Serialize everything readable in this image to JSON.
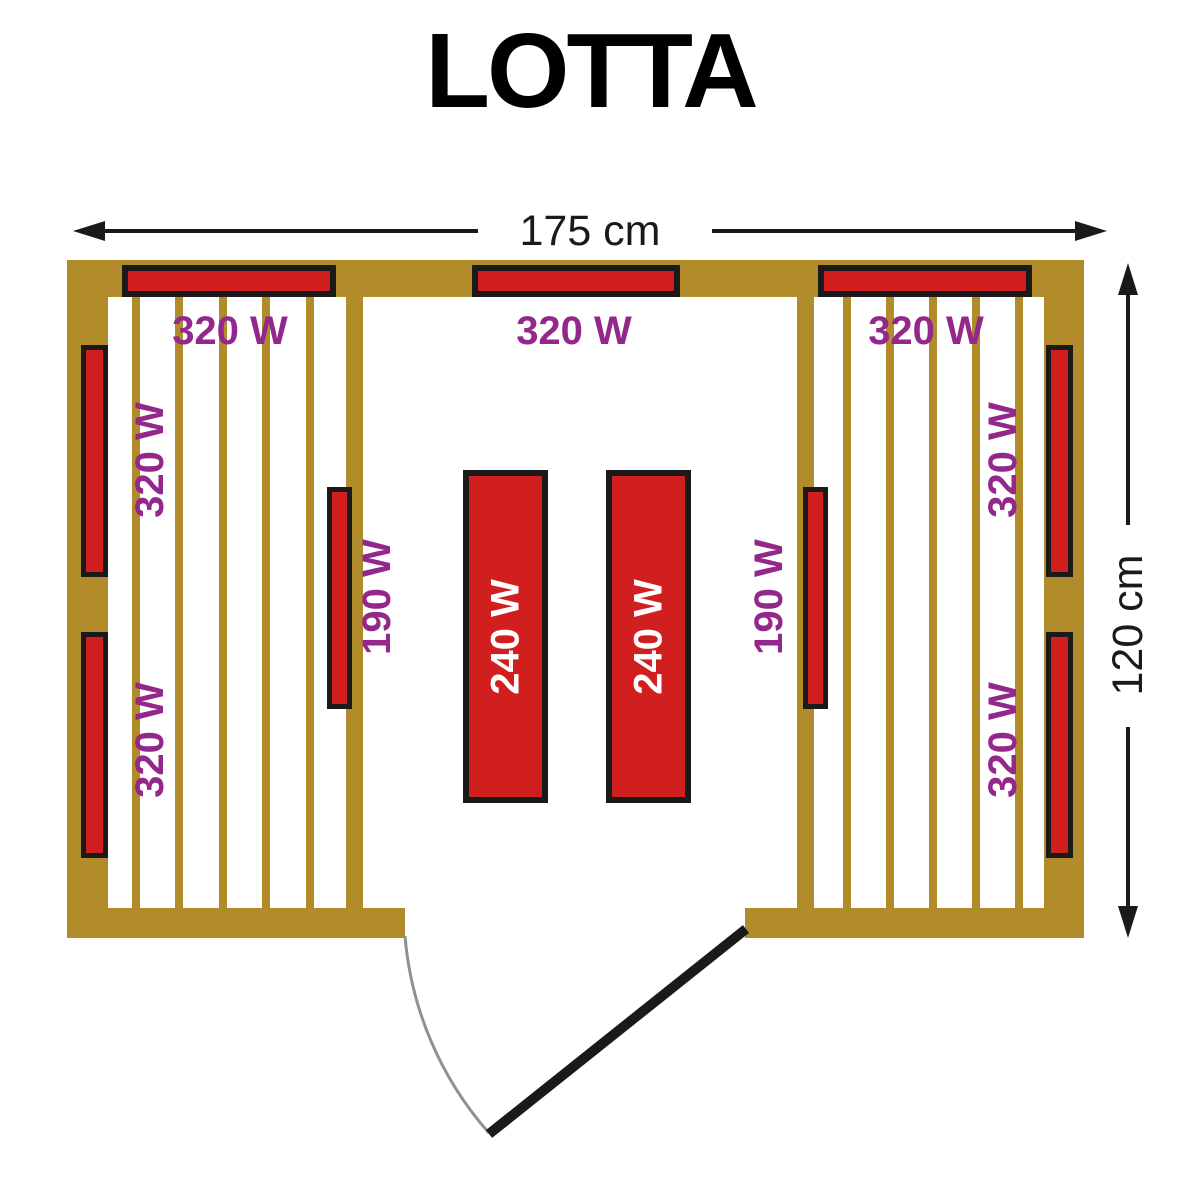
{
  "title": "LOTTA",
  "dimensions": {
    "width_label": "175 cm",
    "height_label": "120 cm"
  },
  "labels": {
    "top_left_heater": "320 W",
    "top_center_heater": "320 W",
    "top_right_heater": "320 W",
    "left_wall_upper_heater": "320 W",
    "left_wall_lower_heater": "320 W",
    "right_wall_upper_heater": "320 W",
    "right_wall_lower_heater": "320 W",
    "left_partition_heater": "190 W",
    "right_partition_heater": "190 W",
    "left_bench_heater": "240 W",
    "right_bench_heater": "240 W"
  },
  "colors": {
    "wall_wood": "#b28c2b",
    "heater_red": "#d11e1e",
    "label_purple": "#93278b",
    "outline_black": "#1a1a1a",
    "bench_label_white": "#ffffff",
    "door_arc_gray": "#909090"
  }
}
